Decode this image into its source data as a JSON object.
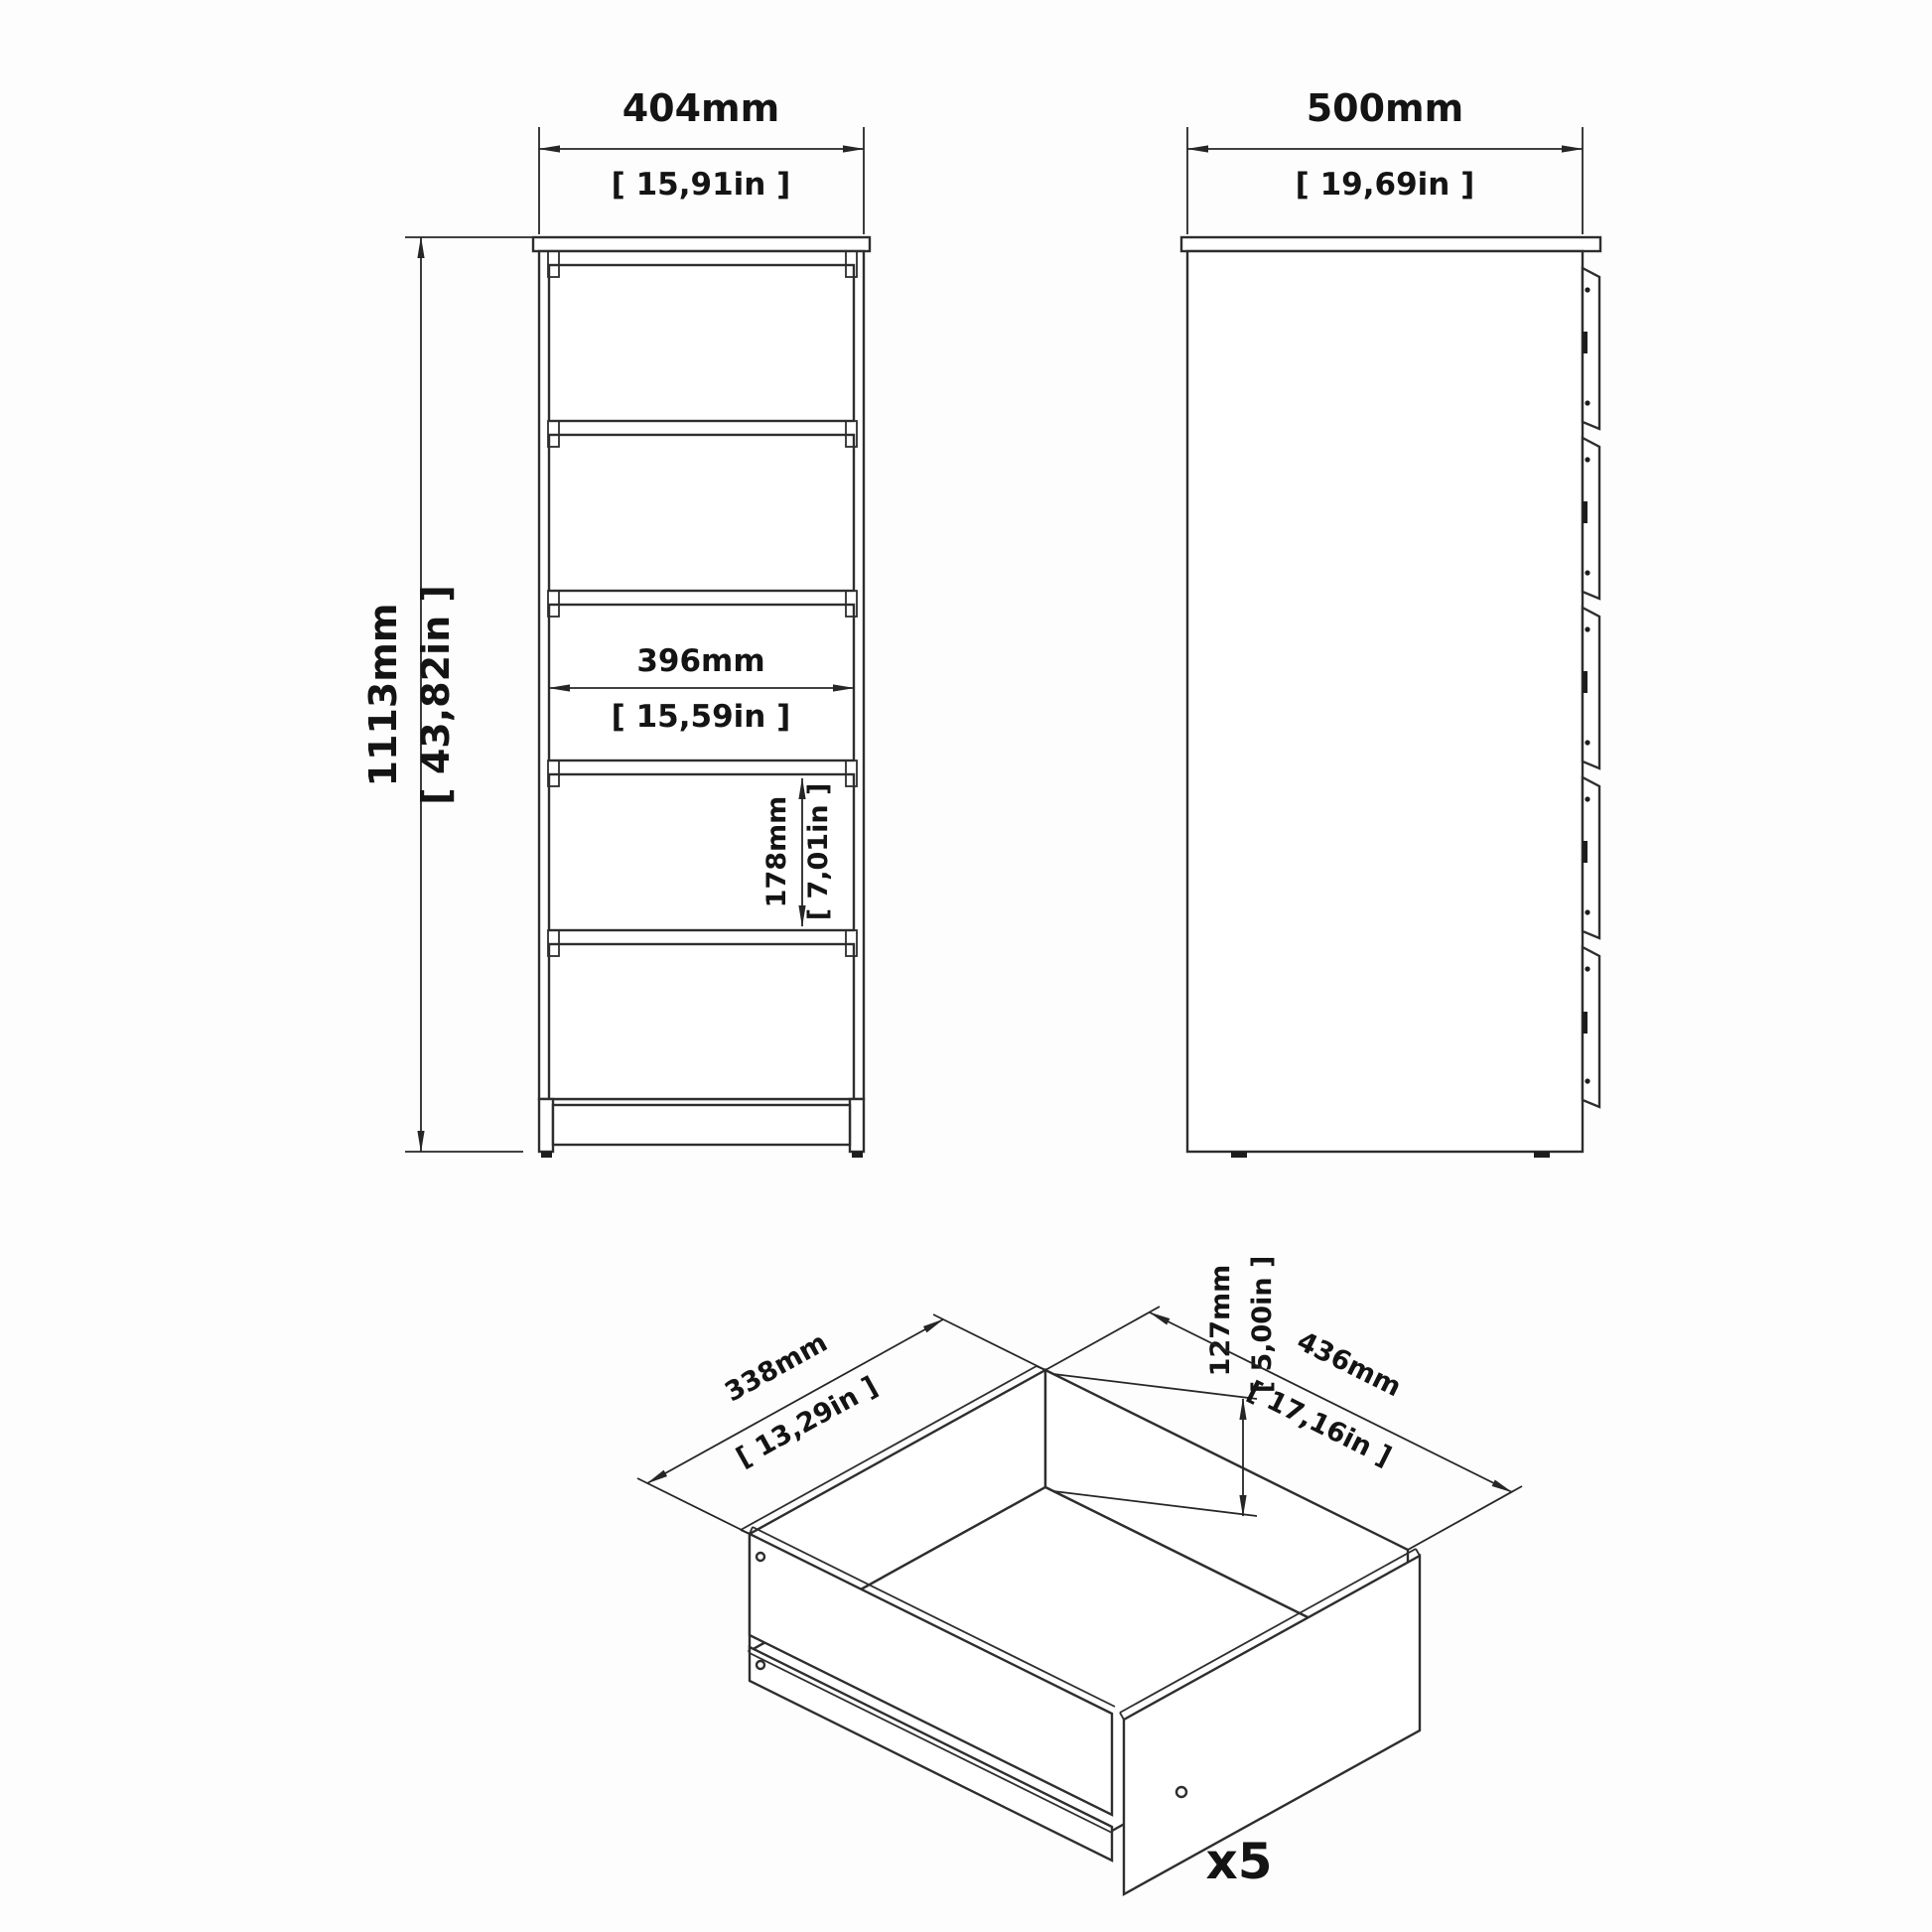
{
  "front_view": {
    "width_dim": {
      "mm": "404mm",
      "in": "[ 15,91in ]"
    },
    "height_dim": {
      "mm": "1113mm",
      "in": "[ 43,82in ]"
    },
    "inner_width_dim": {
      "mm": "396mm",
      "in": "[ 15,59in ]"
    },
    "drawer_height_dim": {
      "mm": "178mm",
      "in": "[ 7,01in ]"
    },
    "drawer_count": 5
  },
  "side_view": {
    "depth_dim": {
      "mm": "500mm",
      "in": "[ 19,69in ]"
    }
  },
  "drawer_detail": {
    "width_dim": {
      "mm": "338mm",
      "in": "[ 13,29in ]"
    },
    "height_dim": {
      "mm": "127mm",
      "in": "[ 5,00in ]"
    },
    "depth_dim": {
      "mm": "436mm",
      "in": "[ 17,16in ]"
    },
    "quantity_label": "x5"
  }
}
